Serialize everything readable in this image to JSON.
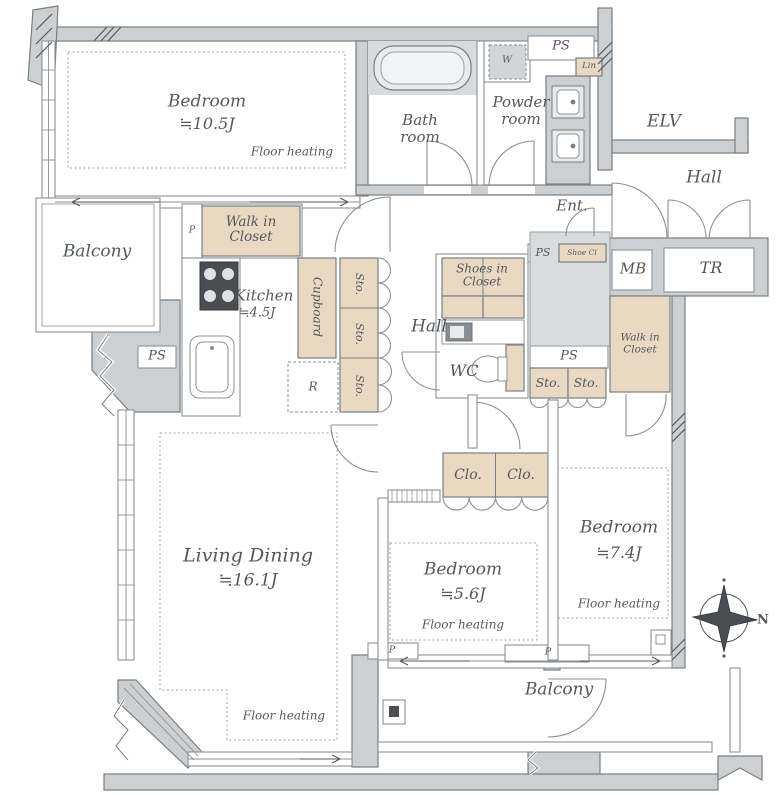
{
  "title": "Apartment floor plan",
  "colors": {
    "wall_fill": "#cdd0d3",
    "wall_stroke": "#7a7e82",
    "closet_beige": "#ead9c2",
    "entrance_tile": "#d9dbdd",
    "text": "#54585d"
  },
  "rooms": {
    "bedroom_main": {
      "name": "Bedroom",
      "size": "≒10.5J",
      "note": "Floor heating"
    },
    "bathroom": {
      "name": "Bath room"
    },
    "powder_room": {
      "name": "Powder room"
    },
    "kitchen": {
      "name": "Kitchen",
      "size": "≒4.5J"
    },
    "living_dining": {
      "name": "Living Dining",
      "size": "≒16.1J",
      "note": "Floor heating"
    },
    "bedroom_2": {
      "name": "Bedroom",
      "size": "≒5.6J",
      "note": "Floor heating"
    },
    "bedroom_3": {
      "name": "Bedroom",
      "size": "≒7.4J",
      "note": "Floor heating"
    },
    "balcony_left": {
      "name": "Balcony"
    },
    "balcony_bottom": {
      "name": "Balcony"
    },
    "hall_upper": {
      "name": "Hall"
    },
    "hall_inner": {
      "name": "Hall"
    },
    "entrance": {
      "name": "Ent."
    },
    "elevator": {
      "name": "ELV"
    },
    "wc": {
      "name": "WC"
    }
  },
  "storage": {
    "walk_in_closet": "Walk in Closet",
    "cupboard": "Cupboard",
    "shoes_in_closet": "Shoes in Closet",
    "shoe_cl": "Shoe Cl",
    "linen": "Lin",
    "sto": "Sto.",
    "clo": "Clo.",
    "fridge": "R",
    "washer": "W"
  },
  "labels": {
    "ps": "PS",
    "p": "P",
    "mb": "MB",
    "tr": "TR",
    "north": "N"
  }
}
